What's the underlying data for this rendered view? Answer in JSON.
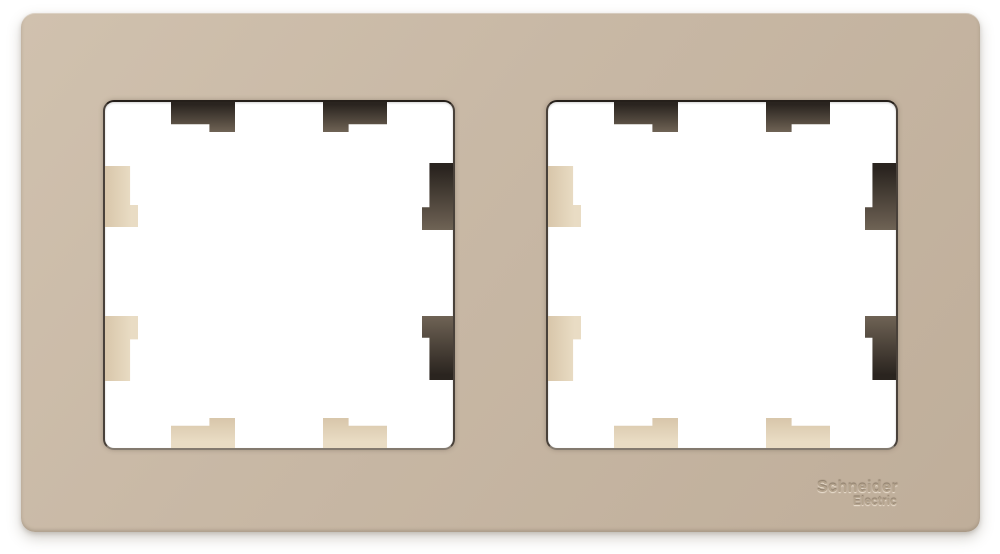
{
  "brand": {
    "line1": "Schneider",
    "line2": "Electric"
  },
  "product": {
    "openings_count": 2,
    "clips_per_opening": 8
  },
  "colors": {
    "background": "#ffffff",
    "frame": "#c8b8a5",
    "frame_light": "#d0c1ae",
    "frame_dark": "#bfae9a",
    "clip_light_a": "#e9dcc4",
    "clip_light_b": "#d8c6aa",
    "clip_dark_a": "#2a241f",
    "clip_dark_b": "#6f6355",
    "opening_border_top": "#251f1a",
    "opening_border_side": "#49413a",
    "opening_border_bottom": "#837a6f",
    "emboss_text": "#b5a48e"
  }
}
